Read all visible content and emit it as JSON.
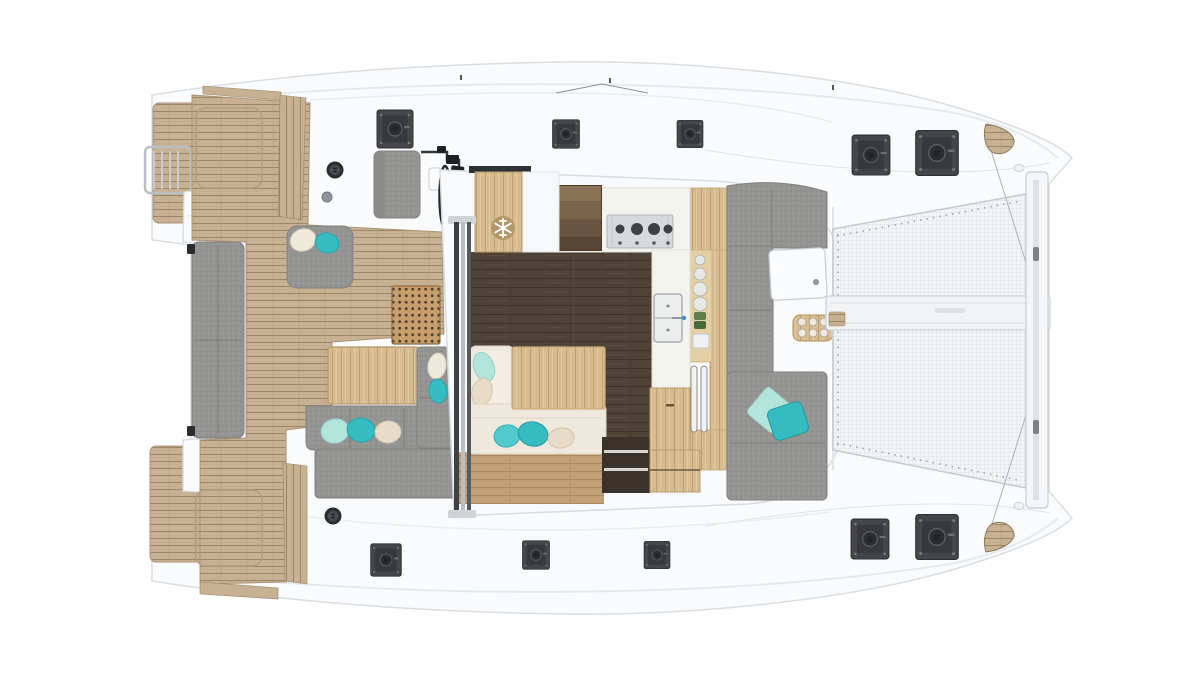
{
  "meta": {
    "title": "Catamaran deck plan — overhead render",
    "view": "top-down",
    "orientation": "bow-right"
  },
  "palette": {
    "background": "#ffffff",
    "hull_white": "#fafbfc",
    "hull_line": "#d9dee3",
    "deck_shadow": "#e6eaee",
    "coachroof": "#f8fafb",
    "teak": "#c7b192",
    "teak_line": "#9c8668",
    "teak_edge": "#a8937a",
    "fabric": "#949492",
    "fabric_seam": "#7b7b79",
    "walnut": "#4f4338",
    "walnut_line": "#3d342b",
    "oak": "#d8bc8f",
    "oak_line": "#c0a173",
    "oak_light": "#e5cfa5",
    "oak_floor": "#c2a077",
    "oak_floor_line": "#a9885f",
    "counter": "#f4f4ee",
    "counter_line": "#dfdfd5",
    "stainless": "#d7dadb",
    "burner": "#3e4044",
    "hatch": "#44464a",
    "hatch_inner": "#37393d",
    "hatch_circle": "#2b2d30",
    "mesh": "#f4f5f6",
    "mesh_line": "#d7dbdf",
    "beam": "#f1f3f5",
    "teal": "#35bcc0",
    "aqua": "#52c9cc",
    "mint": "#b2e6dd",
    "cream": "#e8dcc8",
    "white_cushion": "#efe9dc",
    "grate": "#c79e6e",
    "grate_hole": "#53402c",
    "stair1": "#8a7354",
    "stair2": "#79644a",
    "stair3": "#685440",
    "stair4": "#574636",
    "metal": "#b9bfc5",
    "frame_dark": "#35383b",
    "snowflake_bg": "#b2976b"
  },
  "regions": {
    "hull": {
      "label": "catamaran hull, top view, bow to the right"
    },
    "swim_ladder": {
      "label": "stern swim ladder"
    },
    "stern_platform_port": {
      "label": "port stern teak platform"
    },
    "stern_platform_starboard": {
      "label": "starboard stern teak platform"
    },
    "aft_bench": {
      "label": "stern transom bench"
    },
    "cockpit_deck": {
      "label": "aft cockpit teak deck"
    },
    "cockpit_sofa": {
      "label": "aft cockpit L-shaped sofa"
    },
    "cockpit_chaise": {
      "label": "cockpit chaise pad with cushions"
    },
    "cockpit_table": {
      "label": "aft cockpit wooden table"
    },
    "helm": {
      "label": "helm station"
    },
    "wheel": {
      "label": "steering wheel"
    },
    "grate": {
      "label": "perforated wooden grate"
    },
    "salon": {
      "label": "salon under coachroof"
    },
    "door": {
      "label": "sliding salon door"
    },
    "fridge": {
      "label": "refrigerator cabinet"
    },
    "stairs": {
      "label": "companionway stairs"
    },
    "stove": {
      "label": "four-burner stove"
    },
    "sink": {
      "label": "double galley sink"
    },
    "galley": {
      "label": "L-shaped galley counter"
    },
    "settee": {
      "label": "salon settee with cushions"
    },
    "salon_table": {
      "label": "salon dining table"
    },
    "shelf": {
      "label": "open shelf unit"
    },
    "cabinet": {
      "label": "oak storage cabinet"
    },
    "fore_cockpit": {
      "label": "forward cockpit lounge"
    },
    "fore_table": {
      "label": "forward cockpit table"
    },
    "tray": {
      "label": "wooden serving tray with cups"
    },
    "trampoline": {
      "label": "bow trampoline net"
    },
    "center_beam": {
      "label": "longitudinal center beam"
    },
    "front_beam": {
      "label": "forward crossbeam"
    },
    "hatch": {
      "label": "deck hatch"
    },
    "winch": {
      "label": "winch"
    }
  },
  "icons": {
    "snowflake": {
      "name": "snowflake-icon",
      "meaning": "refrigerator"
    }
  },
  "visible_counts": {
    "deck_hatches": 10,
    "winches": 2,
    "scatter_pillows": 14,
    "stove_burners": 4,
    "sink_basins": 2,
    "tray_cups": 6,
    "stacked_plates": 4
  }
}
